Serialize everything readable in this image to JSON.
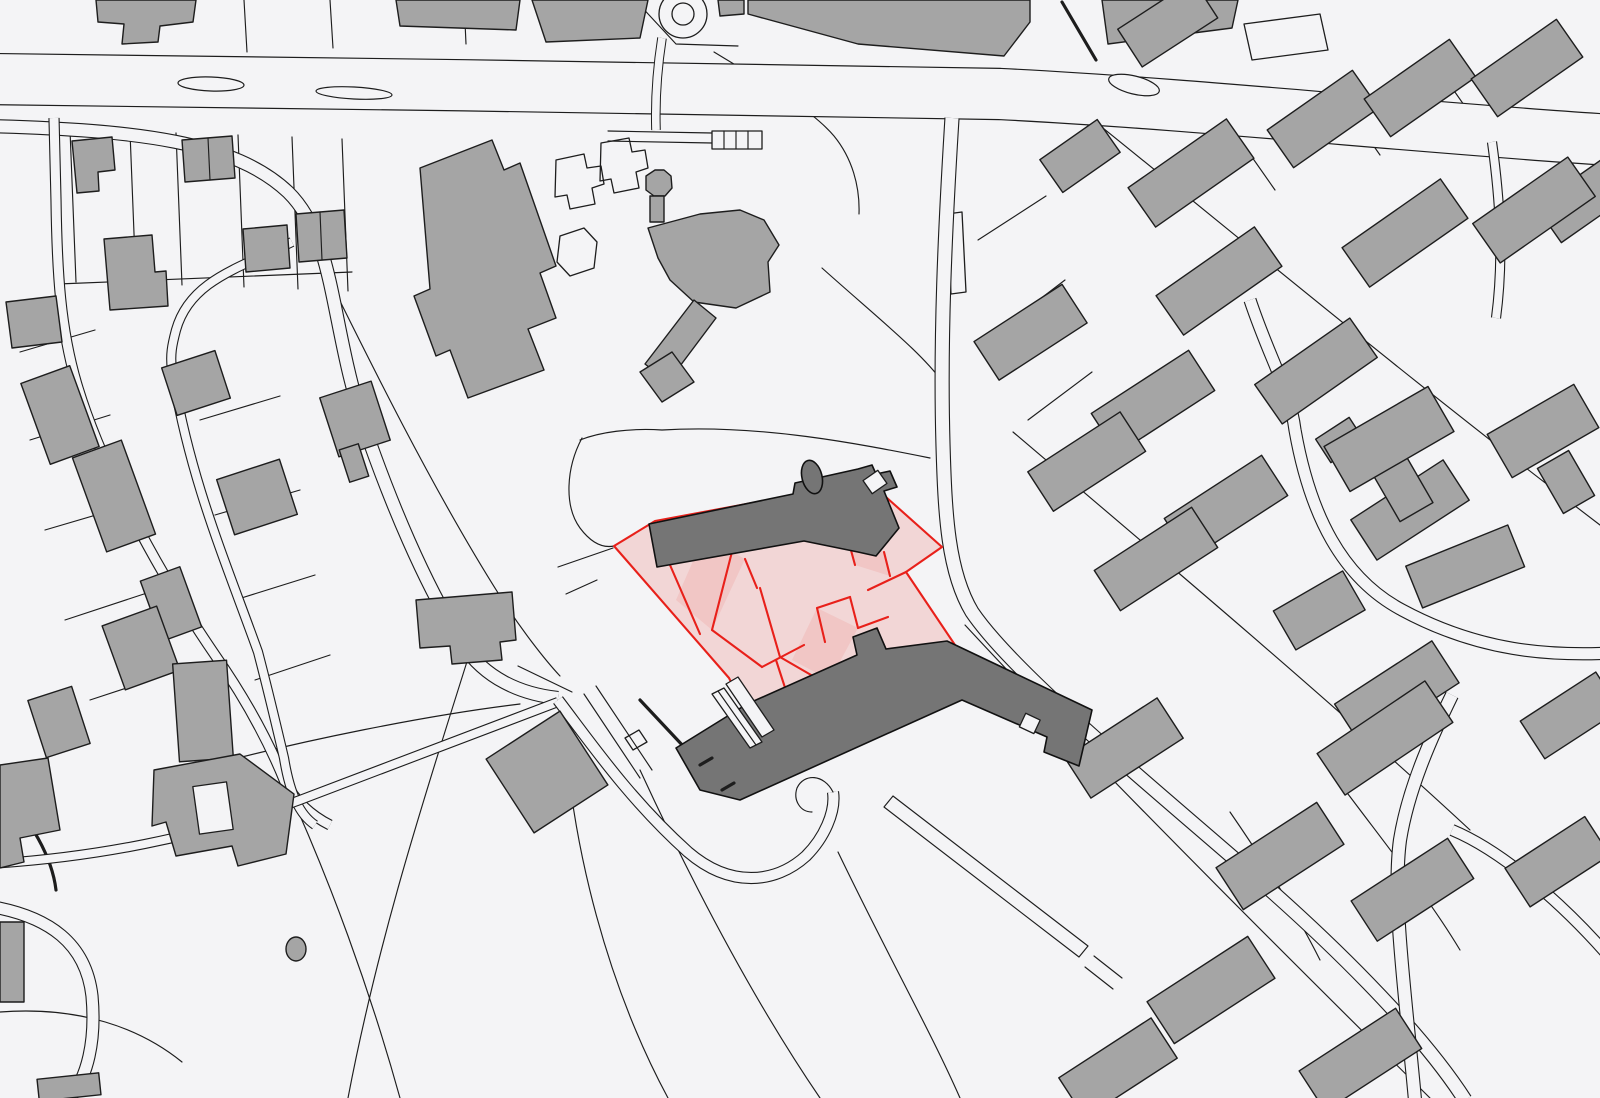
{
  "meta": {
    "description": "Black-and-white cadastral site plan: gray building footprints and parcel lines, a road network, and a red-outlined highlighted development site with pink sub-parcels and two dark gray buildings in the center"
  },
  "colors": {
    "background": "#f4f4f6",
    "line": "#1d1d1d",
    "building-fill": "#a5a5a5",
    "building-dark-fill": "#757575",
    "highlight-stroke": "#e8201a",
    "highlight-fill": "rgba(235,60,48,0.16)",
    "highlight-fill-strong": "rgba(235,60,48,0.10)"
  },
  "map": {
    "type": "cadastral-site-plan",
    "layers": [
      {
        "name": "parcel-lines"
      },
      {
        "name": "roads"
      },
      {
        "name": "traffic-islands"
      },
      {
        "name": "buildings"
      },
      {
        "name": "campus-complex"
      },
      {
        "name": "highlighted-site"
      },
      {
        "name": "site-buildings"
      }
    ],
    "highlighted_site": {
      "sub_parcel_count": 11,
      "dark_building_count": 2
    },
    "traffic_island_count": 3
  }
}
